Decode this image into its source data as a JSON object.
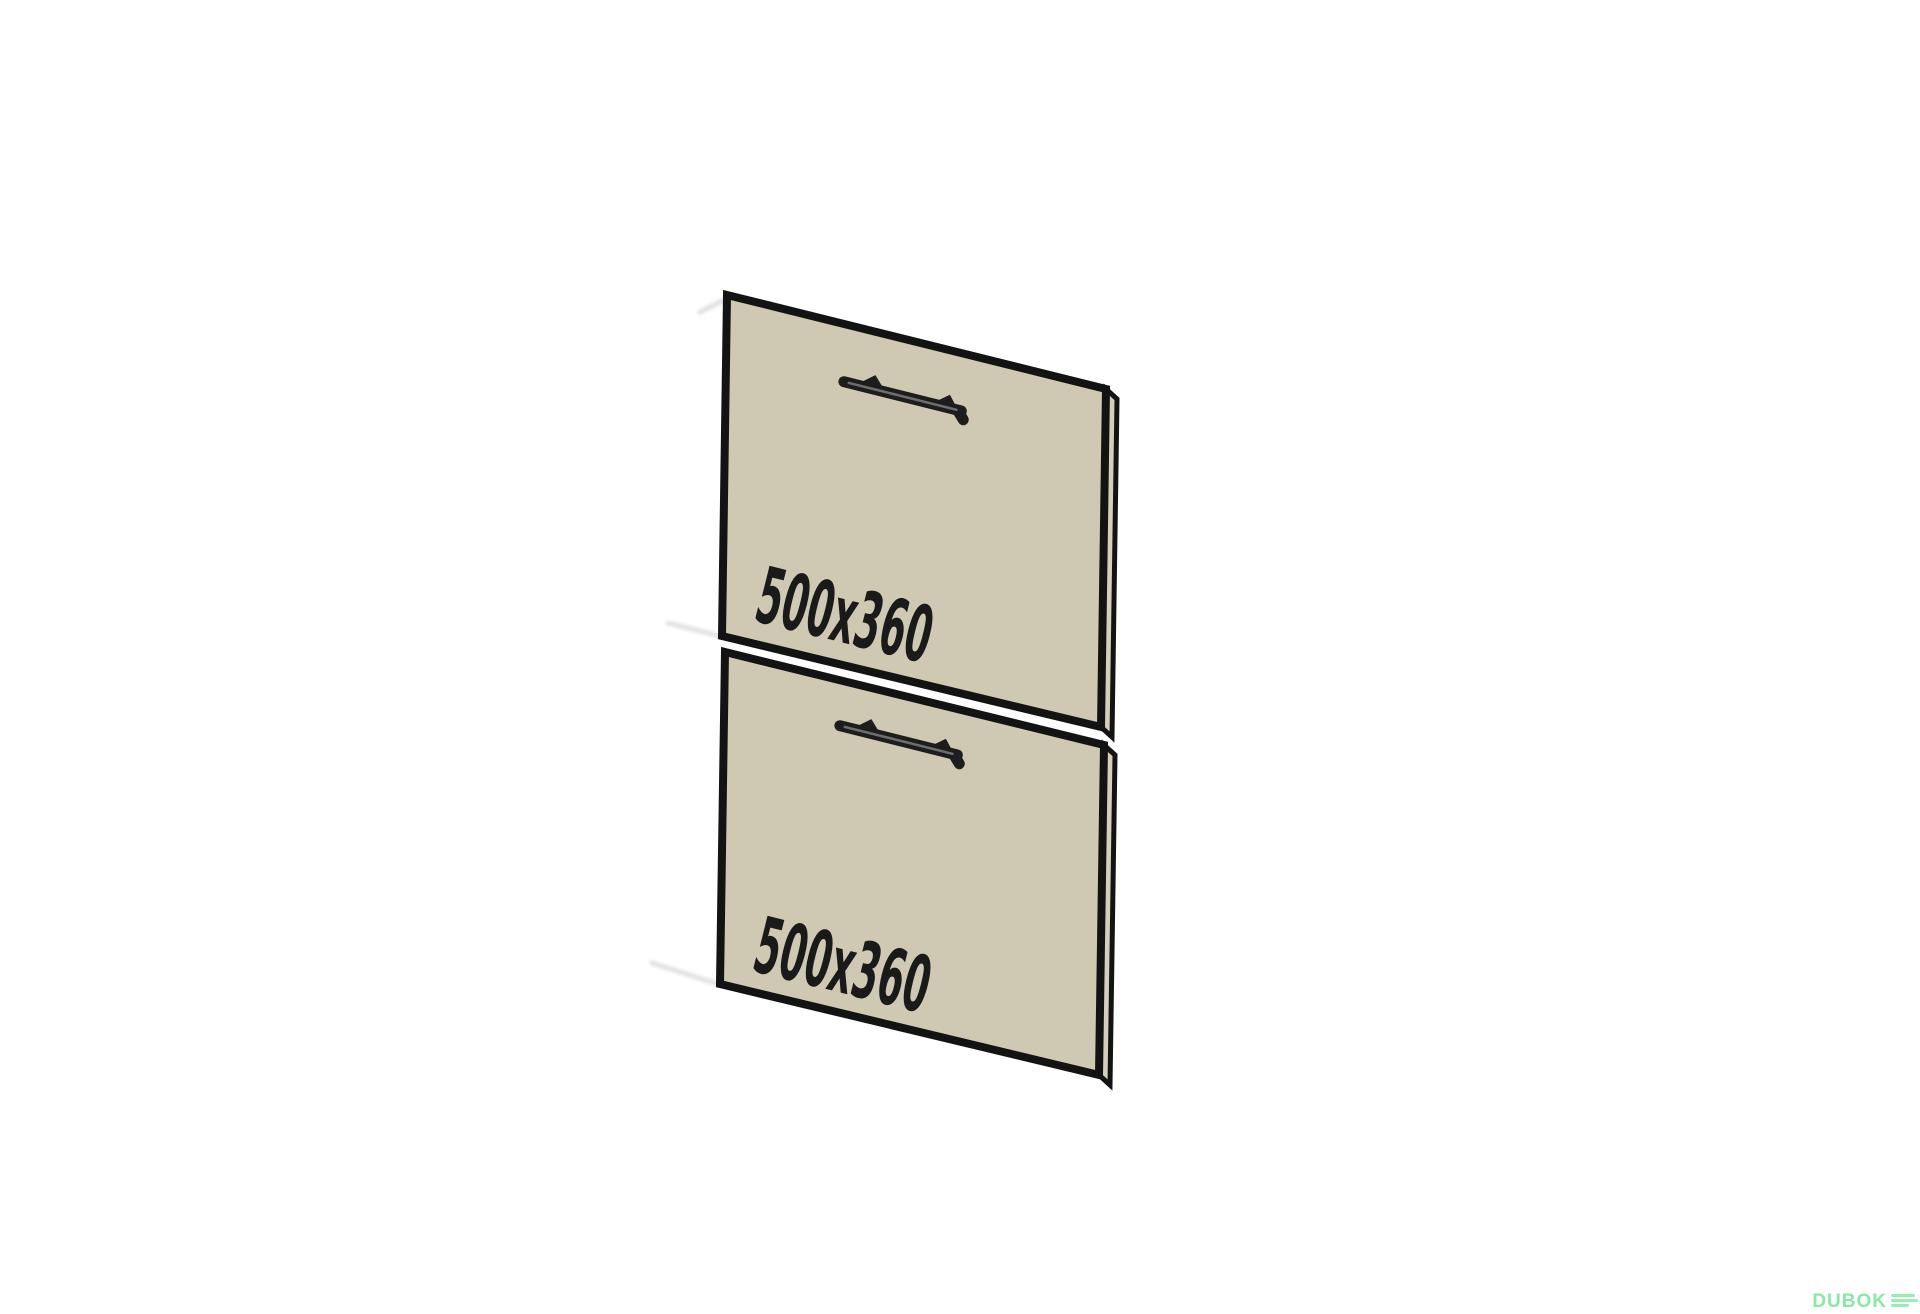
{
  "illustration": {
    "description_labels": {
      "top_panel_dimension": "500x360",
      "bottom_panel_dimension": "500x360"
    }
  },
  "panels": [
    {
      "id": "top-drawer-front",
      "dimension_label": "500x360"
    },
    {
      "id": "bottom-drawer-front",
      "dimension_label": "500x360"
    }
  ],
  "watermark": {
    "logo_text": "DUBOK"
  },
  "colors": {
    "background": "#ffffff",
    "panel_face": "#cfc9b3",
    "panel_edge_face": "#d4ceba",
    "outline": "#131313",
    "handle": "#1d1d1d",
    "label_text": "#1a1a1a",
    "watermark_green": "#87e9a5"
  }
}
